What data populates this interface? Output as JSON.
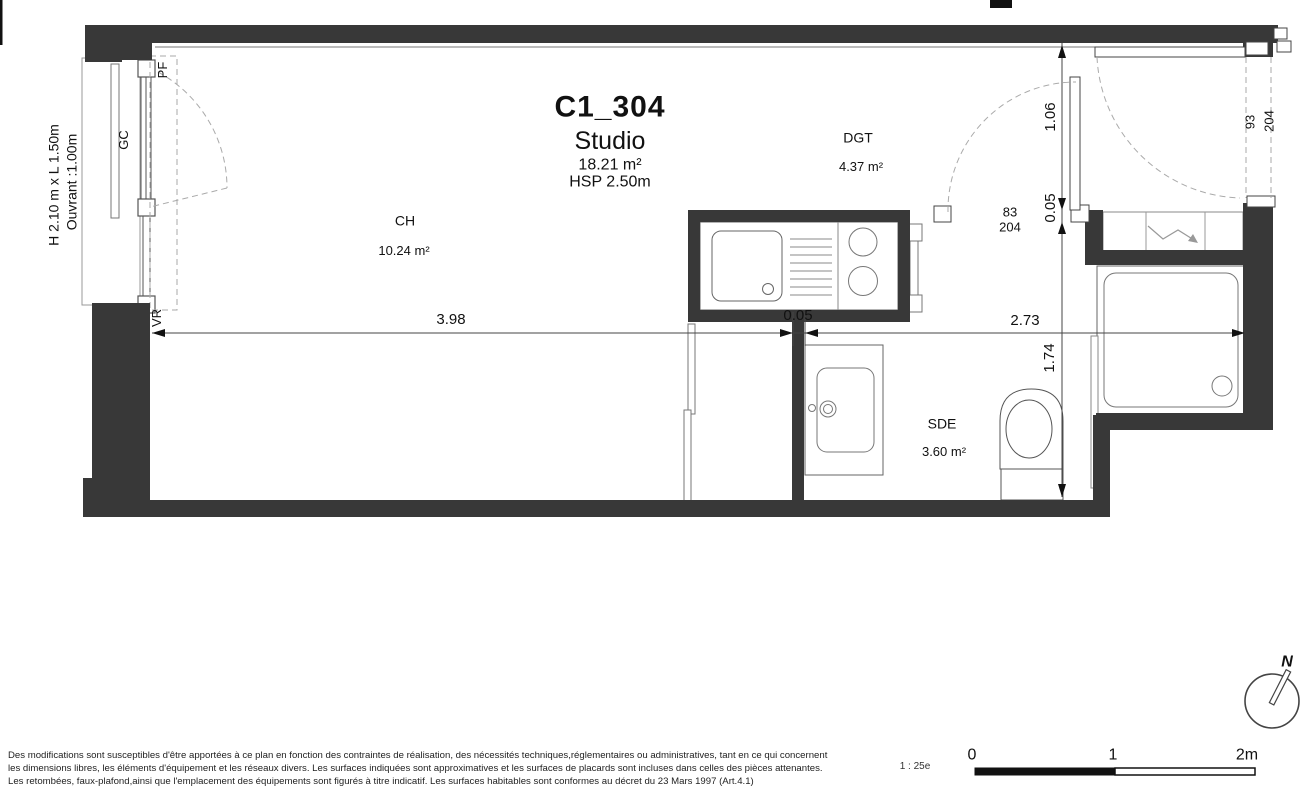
{
  "title": {
    "code": "C1_304",
    "type": "Studio",
    "area": "18.21 m²",
    "ceiling_height": "HSP 2.50m"
  },
  "rooms": {
    "ch": {
      "name": "CH",
      "area": "10.24 m²"
    },
    "dgt": {
      "name": "DGT",
      "area": "4.37 m²"
    },
    "sde": {
      "name": "SDE",
      "area": "3.60 m²"
    }
  },
  "window": {
    "size": "H 2.10 m x L 1.50m",
    "opening": "Ouvrant :1.00m",
    "guardrail": "GC",
    "frame": "PF",
    "shutter": "VR"
  },
  "doors": {
    "interior": {
      "width": "83",
      "height": "204"
    },
    "entrance": {
      "width": "93",
      "height": "204"
    }
  },
  "dims": {
    "ch_width": "3.98",
    "partition": "0.05",
    "right_width": "2.73",
    "entry_depth": "1.06",
    "wall_thk": "0.05",
    "sde_depth": "1.74"
  },
  "scalebar": {
    "ratio": "1 : 25e",
    "t0": "0",
    "t1": "1",
    "t2": "2m"
  },
  "north": {
    "label": "N"
  },
  "disclaimer": {
    "line1": "Des modifications sont susceptibles d'être apportées à ce plan en fonction des contraintes de réalisation, des nécessités techniques,réglementaires ou administratives, tant en ce qui concernent",
    "line2": "les dimensions libres, les éléments d'équipement et les réseaux divers. Les surfaces indiquées sont approximatives et les surfaces de placards sont incluses dans celles des pièces attenantes.",
    "line3": "Les retombées, faux-plafond,ainsi que l'emplacement des équipements sont figurés à titre indicatif. Les surfaces habitables sont conformes au décret du 23 Mars 1997 (Art.4.1)"
  },
  "colors": {
    "wall": "#383838",
    "outline": "#666666",
    "dashed": "#999999",
    "text": "#111111"
  }
}
